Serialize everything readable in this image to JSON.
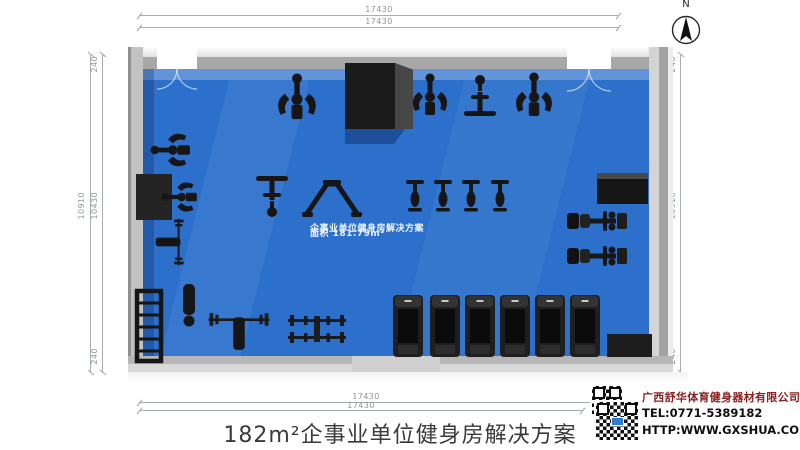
{
  "compass": {
    "label": "N"
  },
  "dimensions": {
    "top_outer": "17430",
    "top_inner": "17430",
    "bottom_inner": "17430",
    "bottom_outer": "17430",
    "left_total": "10910",
    "left_inner": "10430",
    "left_wall_top": "240",
    "left_wall_bottom": "240",
    "right_inner": "10430",
    "right_total": "10910",
    "right_wall_top": "240",
    "right_wall_bottom": "240"
  },
  "floor_label": {
    "line1": "企事业单位健身房解决方案",
    "line2": "面积 181.79m²"
  },
  "title": "182m²企事业单位健身房解决方案",
  "footer": {
    "company": "广西舒华体育健身器材有限公司",
    "tel": "TEL:0771-5389182",
    "url": "HTTP:WWW.GXSHUA.COM"
  },
  "colors": {
    "floor_blue": "#2c70cc",
    "wall_gray": "#c2c2c2",
    "equipment_black": "#161616",
    "company_red": "#8b1e1e",
    "dimension_gray": "#8f949b",
    "title_gray": "#3a3a3a",
    "qr_logo_blue": "#2e7bd6"
  },
  "equipment": [
    {
      "name": "chest-press",
      "type": "station",
      "x": 297,
      "y": 96,
      "rot": 180,
      "scale": 1.1
    },
    {
      "name": "shoulder-press",
      "type": "station",
      "x": 430,
      "y": 94,
      "rot": 180,
      "scale": 1
    },
    {
      "name": "lat-pulldown",
      "type": "pulldown",
      "x": 480,
      "y": 95,
      "rot": 180,
      "scale": 1
    },
    {
      "name": "pec-fly",
      "type": "station",
      "x": 534,
      "y": 94,
      "rot": 180,
      "scale": 1.05
    },
    {
      "name": "arm-curl",
      "type": "station",
      "x": 170,
      "y": 150,
      "rot": 90,
      "scale": 0.95
    },
    {
      "name": "seated-row",
      "type": "station",
      "x": 179,
      "y": 197,
      "rot": 90,
      "scale": 0.85
    },
    {
      "name": "plate-loaded-press",
      "type": "benchpress",
      "x": 170,
      "y": 242,
      "rot": 90,
      "scale": 0.8
    },
    {
      "name": "ladder-rack",
      "type": "rack",
      "x": 149,
      "y": 326,
      "rot": 0,
      "scale": 1
    },
    {
      "name": "flat-bench",
      "type": "bench",
      "x": 189,
      "y": 306,
      "rot": 0,
      "scale": 1
    },
    {
      "name": "cable-station",
      "type": "pulldown",
      "x": 272,
      "y": 197,
      "rot": 0,
      "scale": 1
    },
    {
      "name": "squat-frame",
      "type": "triangle",
      "x": 332,
      "y": 199,
      "rot": 0,
      "scale": 1
    },
    {
      "name": "bench-press",
      "type": "benchpress",
      "x": 239,
      "y": 331,
      "rot": 0,
      "scale": 1.05
    },
    {
      "name": "barbell-rack",
      "type": "dbrack",
      "x": 317,
      "y": 329,
      "rot": 0,
      "scale": 1
    },
    {
      "name": "spin-bike-1",
      "type": "bike",
      "x": 415,
      "y": 196,
      "rot": 0,
      "scale": 1
    },
    {
      "name": "spin-bike-2",
      "type": "bike",
      "x": 443,
      "y": 196,
      "rot": 0,
      "scale": 1
    },
    {
      "name": "spin-bike-3",
      "type": "bike",
      "x": 471,
      "y": 196,
      "rot": 0,
      "scale": 1
    },
    {
      "name": "spin-bike-4",
      "type": "bike",
      "x": 500,
      "y": 196,
      "rot": 0,
      "scale": 1
    },
    {
      "name": "leg-press-1",
      "type": "rower",
      "x": 598,
      "y": 221,
      "rot": 0,
      "scale": 1
    },
    {
      "name": "leg-press-2",
      "type": "rower",
      "x": 598,
      "y": 256,
      "rot": 0,
      "scale": 1
    },
    {
      "name": "treadmill-1",
      "type": "treadmill",
      "x": 408,
      "y": 326,
      "rot": 0,
      "scale": 1
    },
    {
      "name": "treadmill-2",
      "type": "treadmill",
      "x": 445,
      "y": 326,
      "rot": 0,
      "scale": 1
    },
    {
      "name": "treadmill-3",
      "type": "treadmill",
      "x": 480,
      "y": 326,
      "rot": 0,
      "scale": 1
    },
    {
      "name": "treadmill-4",
      "type": "treadmill",
      "x": 515,
      "y": 326,
      "rot": 0,
      "scale": 1
    },
    {
      "name": "treadmill-5",
      "type": "treadmill",
      "x": 550,
      "y": 326,
      "rot": 0,
      "scale": 1
    },
    {
      "name": "treadmill-6",
      "type": "treadmill",
      "x": 585,
      "y": 326,
      "rot": 0,
      "scale": 1
    }
  ]
}
